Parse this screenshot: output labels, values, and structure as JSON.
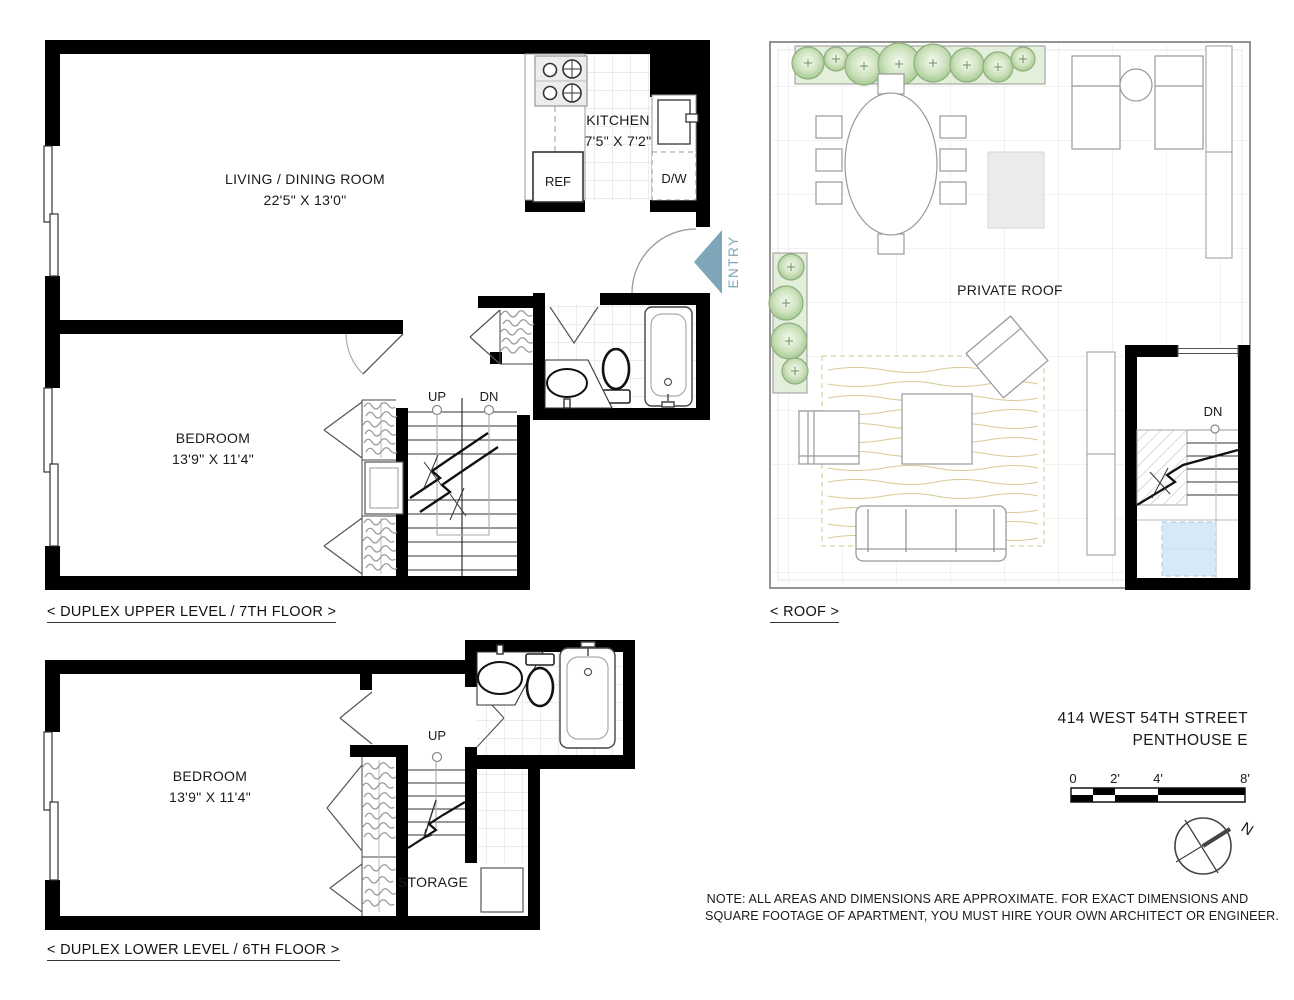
{
  "upper_plan": {
    "caption": "< DUPLEX UPPER LEVEL / 7TH FLOOR >",
    "living_room": {
      "name": "LIVING / DINING ROOM",
      "dims": "22'5\" X 13'0\""
    },
    "kitchen": {
      "name": "KITCHEN",
      "dims": "7'5\" X 7'2\"",
      "ref": "REF",
      "dw": "D/W"
    },
    "bedroom": {
      "name": "BEDROOM",
      "dims": "13'9\" X 11'4\""
    },
    "stairs": {
      "up": "UP",
      "dn": "DN"
    },
    "entry": {
      "label": "ENTRY"
    }
  },
  "roof_plan": {
    "caption": "< ROOF >",
    "area_label": "PRIVATE ROOF",
    "stairs": {
      "dn": "DN"
    }
  },
  "lower_plan": {
    "caption": "< DUPLEX LOWER LEVEL / 6TH FLOOR >",
    "bedroom": {
      "name": "BEDROOM",
      "dims": "13'9\" X 11'4\""
    },
    "storage": {
      "label": "STORAGE"
    },
    "stairs": {
      "up": "UP"
    }
  },
  "title_block": {
    "address_line1": "414 WEST 54TH STREET",
    "address_line2": "PENTHOUSE E",
    "note_line1": "NOTE: ALL AREAS AND DIMENSIONS ARE APPROXIMATE. FOR EXACT DIMENSIONS AND",
    "note_line2": "SQUARE FOOTAGE OF APARTMENT, YOU MUST HIRE YOUR OWN ARCHITECT OR ENGINEER.",
    "scale_bar": {
      "ticks": [
        "0",
        "2'",
        "4'",
        "8'"
      ]
    },
    "compass": {
      "north": "N"
    }
  },
  "colors": {
    "wall": "#000000",
    "entry_arrow": "#7fa6b8",
    "tree_green": "#a8cf97",
    "planter_green": "#e4efdb",
    "rug_tan": "#d6c48c",
    "skylight_blue": "#d6e9f8"
  }
}
